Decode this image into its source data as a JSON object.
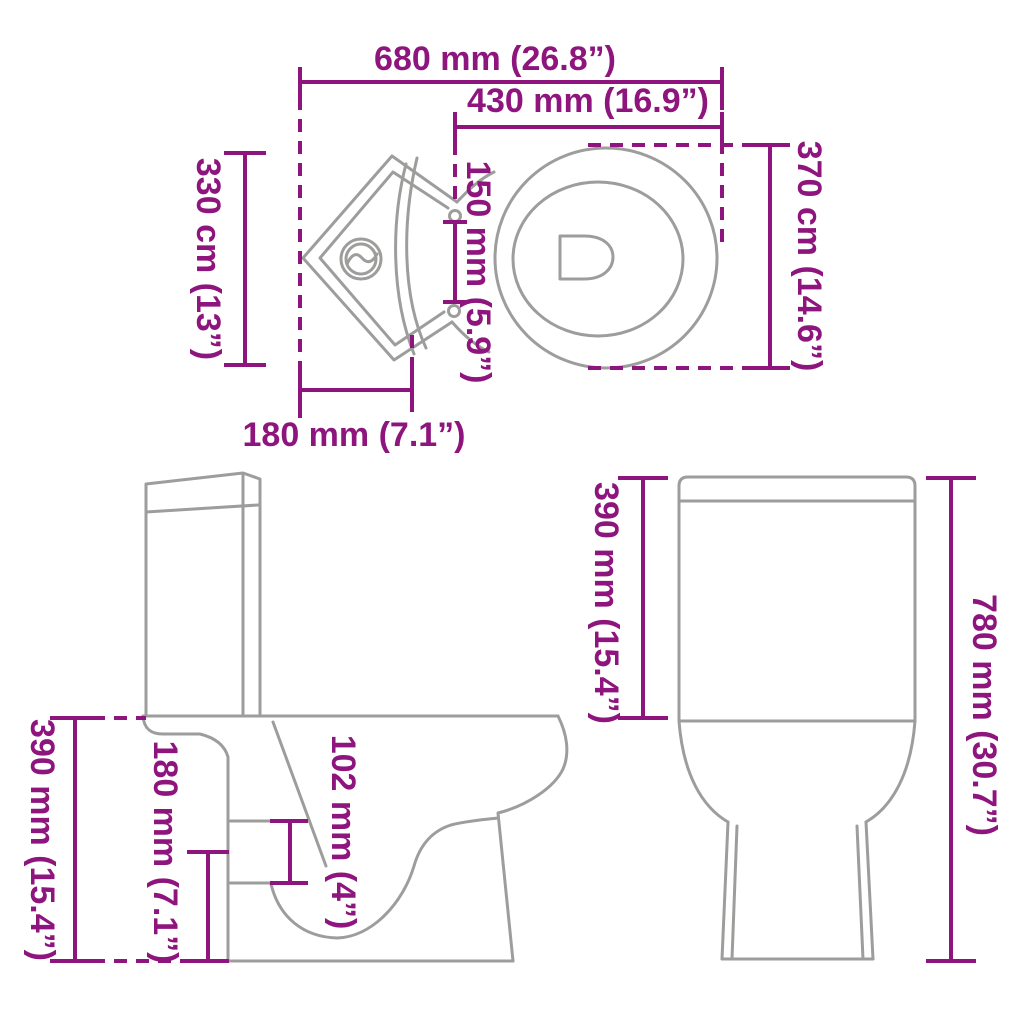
{
  "diagram_title": "corner toilet dimension drawing",
  "colors": {
    "dimension": "#8e157d",
    "outline": "#9d9d9c",
    "background": "#ffffff"
  },
  "views": {
    "top": {
      "name": "top view",
      "dimensions": {
        "overall_width": "680 mm (26.8”)",
        "seat_width": "430 mm (16.9”)",
        "back_left_side": "330 cm (13”)",
        "hinge_spacing": "150 mm (5.9”)",
        "seat_depth": "370 cm (14.6”)",
        "corner_to_front": "180 mm (7.1”)"
      }
    },
    "side": {
      "name": "side view",
      "dimensions": {
        "bowl_height": "390 mm (15.4”)",
        "outlet_height": "180 mm (7.1”)",
        "outlet_size": "102 mm (4”)"
      }
    },
    "front": {
      "name": "front view",
      "dimensions": {
        "tank_height": "390 mm (15.4”)",
        "total_height": "780 mm (30.7”)"
      }
    }
  }
}
